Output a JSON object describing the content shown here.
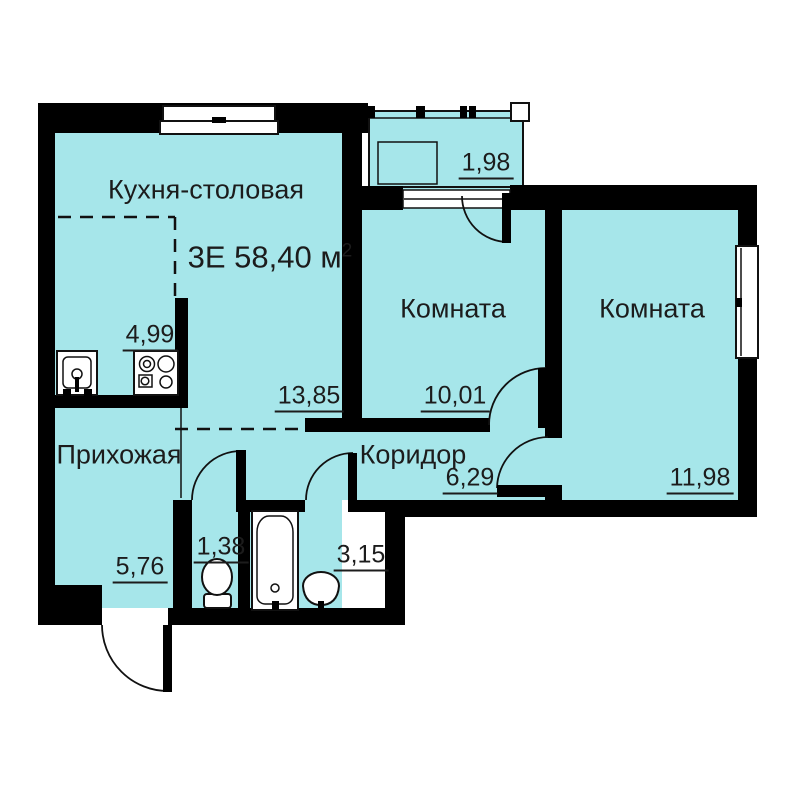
{
  "colors": {
    "room_fill": "#a6e6ea",
    "wall": "#000000",
    "text": "#1c1c1c",
    "background": "#ffffff"
  },
  "plan": {
    "title": {
      "main": "3Е 58,40 м",
      "sup": "2"
    },
    "rooms": {
      "kitchen": {
        "name": "Кухня-столовая",
        "dining_area": "13,85",
        "cooking_area": "4,99"
      },
      "bedroom1": {
        "name": "Комната",
        "area": "10,01"
      },
      "bedroom2": {
        "name": "Комната",
        "area": "11,98"
      },
      "hallway": {
        "name": "Прихожая",
        "area": "5,76"
      },
      "corridor": {
        "name": "Коридор",
        "area": "6,29"
      },
      "wc": {
        "area": "1,38"
      },
      "bathroom": {
        "area": "3,15"
      },
      "balcony": {
        "area": "1,98"
      }
    }
  }
}
